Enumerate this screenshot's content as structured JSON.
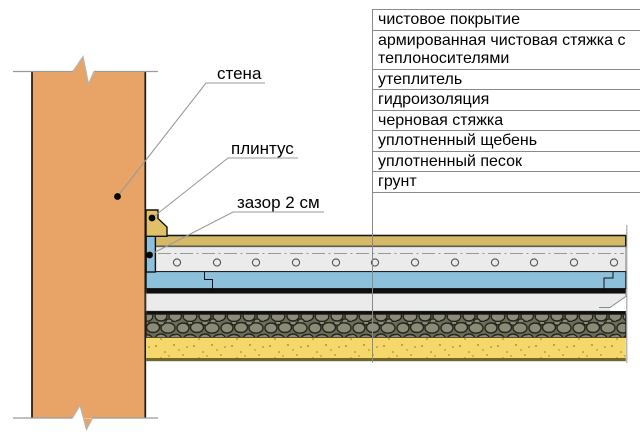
{
  "diagram": {
    "labels": {
      "wall": "стена",
      "plinth": "плинтус",
      "gap": "зазор 2 см"
    }
  },
  "legend": {
    "items": [
      "чистовое покрытие",
      "армированная чистовая стяжка с теплоносителями",
      "утеплитель",
      "гидроизоляция",
      "черновая стяжка",
      "уплотненный щебень",
      "уплотненный песок",
      "грунт"
    ]
  },
  "colors": {
    "wall": "#E8A467",
    "plinth": "#E0C168",
    "finish_coating": "#D5B967",
    "finish_screed": "#EBEBEB",
    "insulation": "#8DC1DB",
    "waterproofing": "#0E0E0E",
    "rough_screed": "#EBEBEB",
    "crushed_stone": "#8B8B77",
    "sand": "#F6D76C",
    "sand_bottom_border": "#6E682B",
    "leader_line": "#999999",
    "table_line": "#8A8A8A"
  }
}
